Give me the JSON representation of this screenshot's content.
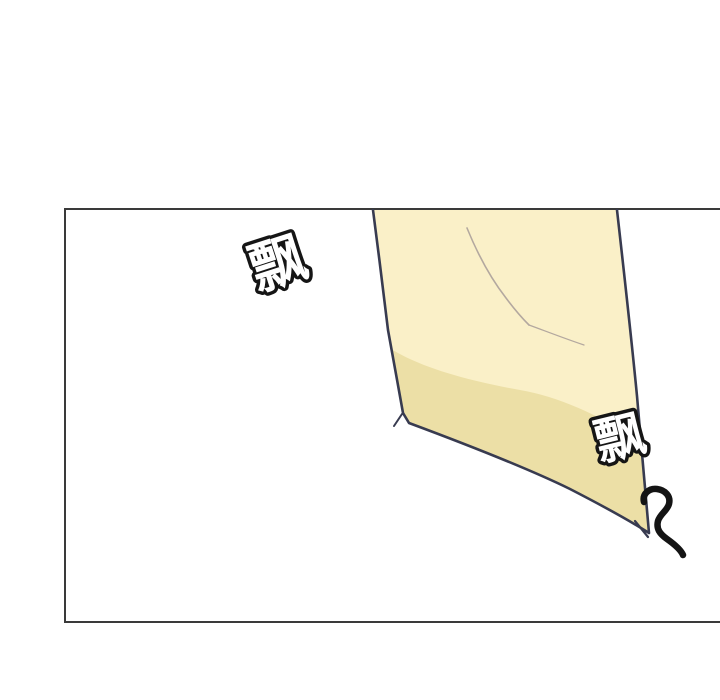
{
  "page": {
    "background": "#ffffff"
  },
  "panel": {
    "border_color": "#3a3a3a"
  },
  "artwork": {
    "description_colors": {
      "cloth_light": "#faf0c8",
      "cloth_shadow": "#ecdfa6",
      "cloth_outline": "#383b50",
      "crease": "#b3a89f",
      "squiggle": "#141414",
      "sfx_fill": "#ffffff",
      "sfx_stroke": "#151515"
    }
  },
  "sfx": [
    {
      "text": "飘"
    },
    {
      "text": "飘"
    }
  ]
}
